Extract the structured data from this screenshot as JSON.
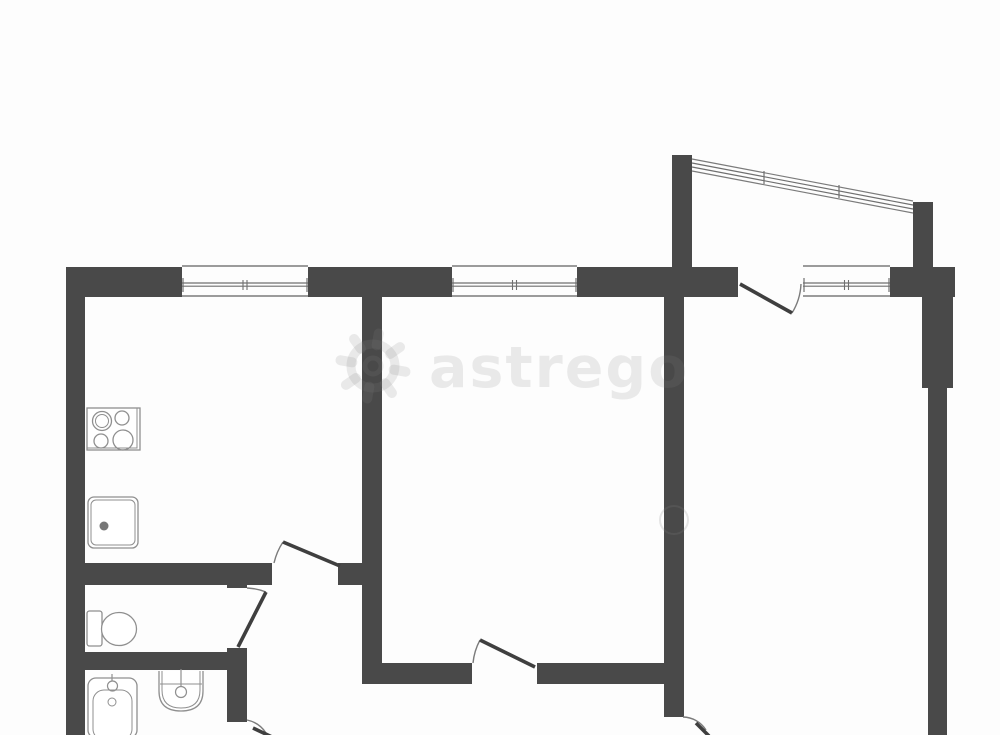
{
  "watermark": {
    "text": "astrego",
    "icon": "gear-icon",
    "text_x": 429,
    "text_y": 387,
    "font_size": 57,
    "gear": {
      "cx": 373,
      "cy": 366,
      "r_ring": 22,
      "r_hole": 8,
      "tooth_inner": 21,
      "tooth_outer": 33
    },
    "faint_circle": {
      "cx": 674,
      "cy": 520,
      "r": 14
    }
  },
  "colors": {
    "background": "#fdfdfd",
    "wall": "#494949",
    "line": "#7b7b7b",
    "glaze": "#6f6f6f",
    "fixture": "#8f8f8f",
    "fixture_dark": "#777777",
    "door_leaf": "#3f3f3f",
    "watermark_fill": "rgba(128,128,128,0.16)",
    "watermark_stroke": "rgba(128,128,128,0.20)"
  },
  "plan": {
    "width": 1000,
    "height": 735,
    "walls": [
      {
        "name": "exterior-top-left",
        "x": 66,
        "y": 267,
        "w": 116,
        "h": 30
      },
      {
        "name": "exterior-top-mid",
        "x": 308,
        "y": 267,
        "w": 144,
        "h": 30
      },
      {
        "name": "exterior-top-mid2",
        "x": 577,
        "y": 267,
        "w": 161,
        "h": 30
      },
      {
        "name": "exterior-top-right",
        "x": 890,
        "y": 267,
        "w": 65,
        "h": 30
      },
      {
        "name": "exterior-left",
        "x": 66,
        "y": 267,
        "w": 19,
        "h": 468
      },
      {
        "name": "partition-kitchen-living",
        "x": 362,
        "y": 297,
        "w": 20,
        "h": 386
      },
      {
        "name": "partition-living-bedroom",
        "x": 664,
        "y": 297,
        "w": 20,
        "h": 420
      },
      {
        "name": "exterior-right-pilaster",
        "x": 922,
        "y": 297,
        "w": 31,
        "h": 91
      },
      {
        "name": "exterior-right",
        "x": 928,
        "y": 388,
        "w": 19,
        "h": 347
      },
      {
        "name": "kitchen-bottom",
        "x": 85,
        "y": 563,
        "w": 187,
        "h": 22
      },
      {
        "name": "kitchen-door-pillar",
        "x": 338,
        "y": 563,
        "w": 44,
        "h": 22
      },
      {
        "name": "wc-right-top-stub",
        "x": 227,
        "y": 563,
        "w": 20,
        "h": 25
      },
      {
        "name": "wc-right-bottom-stub",
        "x": 227,
        "y": 648,
        "w": 20,
        "h": 22
      },
      {
        "name": "wc-bath-divider",
        "x": 66,
        "y": 652,
        "w": 181,
        "h": 18
      },
      {
        "name": "bathroom-right",
        "x": 227,
        "y": 670,
        "w": 20,
        "h": 52
      },
      {
        "name": "hall-bottom-left",
        "x": 362,
        "y": 663,
        "w": 110,
        "h": 21
      },
      {
        "name": "hall-bottom-right",
        "x": 537,
        "y": 663,
        "w": 147,
        "h": 21
      },
      {
        "name": "balcony-left",
        "x": 672,
        "y": 155,
        "w": 20,
        "h": 112
      },
      {
        "name": "balcony-right",
        "x": 913,
        "y": 202,
        "w": 20,
        "h": 65
      }
    ],
    "windows": [
      {
        "name": "kitchen-window",
        "x1": 182,
        "x2": 308
      },
      {
        "name": "living-room-window",
        "x1": 452,
        "x2": 577
      },
      {
        "name": "bedroom-window",
        "x1": 803,
        "x2": 890
      }
    ],
    "window_band": {
      "top": 266,
      "bottom": 296,
      "glaze1": 283,
      "glaze2": 286.2
    },
    "balcony_window": {
      "name": "balcony-window",
      "x1": 692,
      "y1": 159,
      "x2": 913,
      "y2": 201,
      "offsets": [
        0,
        4,
        8,
        12
      ],
      "ticks": [
        [
          764,
          171
        ],
        [
          839,
          185
        ]
      ]
    },
    "doors": [
      {
        "name": "kitchen-door",
        "leaf": [
          283,
          542,
          340,
          566
        ],
        "arc": "M 274 563 A 64 64 0 0 1 283 542"
      },
      {
        "name": "wc-door",
        "leaf": [
          238,
          647,
          266,
          592
        ],
        "arc": "M 247 588 A 60 60 0 0 1 266 592"
      },
      {
        "name": "hall-door",
        "leaf": [
          535,
          667,
          480,
          640
        ],
        "arc": "M 473 663 A 61 61 0 0 1 480 640"
      },
      {
        "name": "balcony-door",
        "leaf": [
          740,
          284,
          792,
          313
        ],
        "arc": "M 801 284 A 60 60 0 0 1 792 313"
      },
      {
        "name": "bathroom-door",
        "leaf": [
          253,
          728,
          272,
          737
        ],
        "arc": "M 247 720 A 30 30 0 0 1 266 733"
      },
      {
        "name": "bedroom-door",
        "leaf": [
          696,
          723,
          709,
          736
        ],
        "arc": "M 683 717 A 28 28 0 0 1 706 730"
      }
    ],
    "fixtures": {
      "stove": {
        "rect": [
          87,
          408,
          53,
          42
        ],
        "inner_rect": [
          87,
          408,
          50,
          40
        ],
        "burners": [
          [
            102,
            421,
            9.5
          ],
          [
            122,
            418,
            7
          ],
          [
            101,
            441,
            7
          ],
          [
            123,
            440,
            10
          ]
        ],
        "burner_inner": [
          102,
          421,
          6.5
        ]
      },
      "kitchen_sink": {
        "rect": [
          88,
          497,
          50,
          51
        ],
        "inner_rect": [
          91,
          500,
          44,
          45
        ],
        "drain": [
          104,
          526,
          4.5
        ]
      },
      "toilet": {
        "tank": [
          87,
          611,
          15,
          35
        ],
        "bowl": [
          119,
          629,
          17.5,
          16.5
        ]
      },
      "bathtub": {
        "rect": [
          88,
          678,
          49,
          60
        ],
        "inner_rect": [
          93,
          690,
          39,
          50
        ],
        "faucet": [
          112.5,
          686,
          5
        ],
        "faucet_line": [
          112,
          674,
          112,
          681
        ],
        "drain": [
          112,
          702,
          4
        ]
      },
      "bath_sink": {
        "outer": "M 159 671 L 159 691 Q 159 711 181 711 Q 203 711 203 691 L 203 671",
        "inner": "M 162 671 L 162 690 Q 162 708 181 708 Q 200 708 200 690 L 200 671",
        "back_line": [
          160,
          684,
          202,
          684
        ],
        "faucet": [
          181,
          692,
          5.5
        ],
        "faucet_line": [
          181,
          669,
          181,
          687
        ]
      }
    }
  }
}
